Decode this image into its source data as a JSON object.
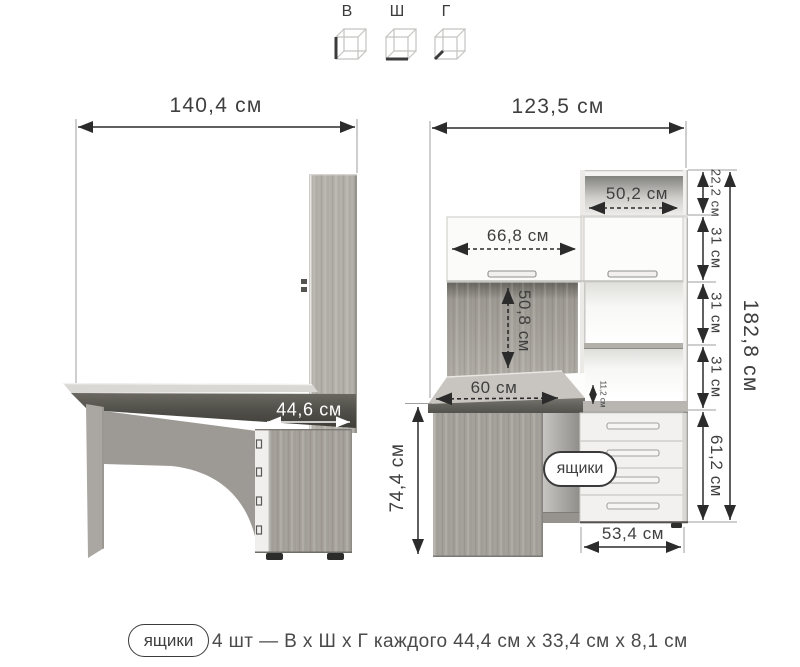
{
  "size_key": {
    "height_label": "В",
    "width_label": "Ш",
    "depth_label": "Г"
  },
  "left_view": {
    "overall_width": "140,4 см",
    "desk_depth": "44,6 см"
  },
  "right_view": {
    "overall_width": "123,5 см",
    "top_shelf_width": "50,2 см",
    "door_width": "66,8 см",
    "back_panel_height": "50,8 см",
    "desktop_depth": "60 см",
    "desktop_gap": "11,2 см",
    "desk_height": "74,4 см",
    "height_segments": [
      "22,2 см",
      "31 см",
      "31 см",
      "31 см"
    ],
    "drawer_section_height": "61,2 см",
    "overall_height": "182,8 см",
    "drawer_unit_width": "53,4 см",
    "drawers_callout": "ящики"
  },
  "legend": {
    "badge": "ящики",
    "text": "4 шт — В х Ш х Г каждого 44,4 см х 33,4 см х 8,1 см"
  },
  "colors": {
    "dimension_line": "#2b2b2b",
    "label_text": "#3f3f3f",
    "highlight_text": "#ffffff"
  }
}
